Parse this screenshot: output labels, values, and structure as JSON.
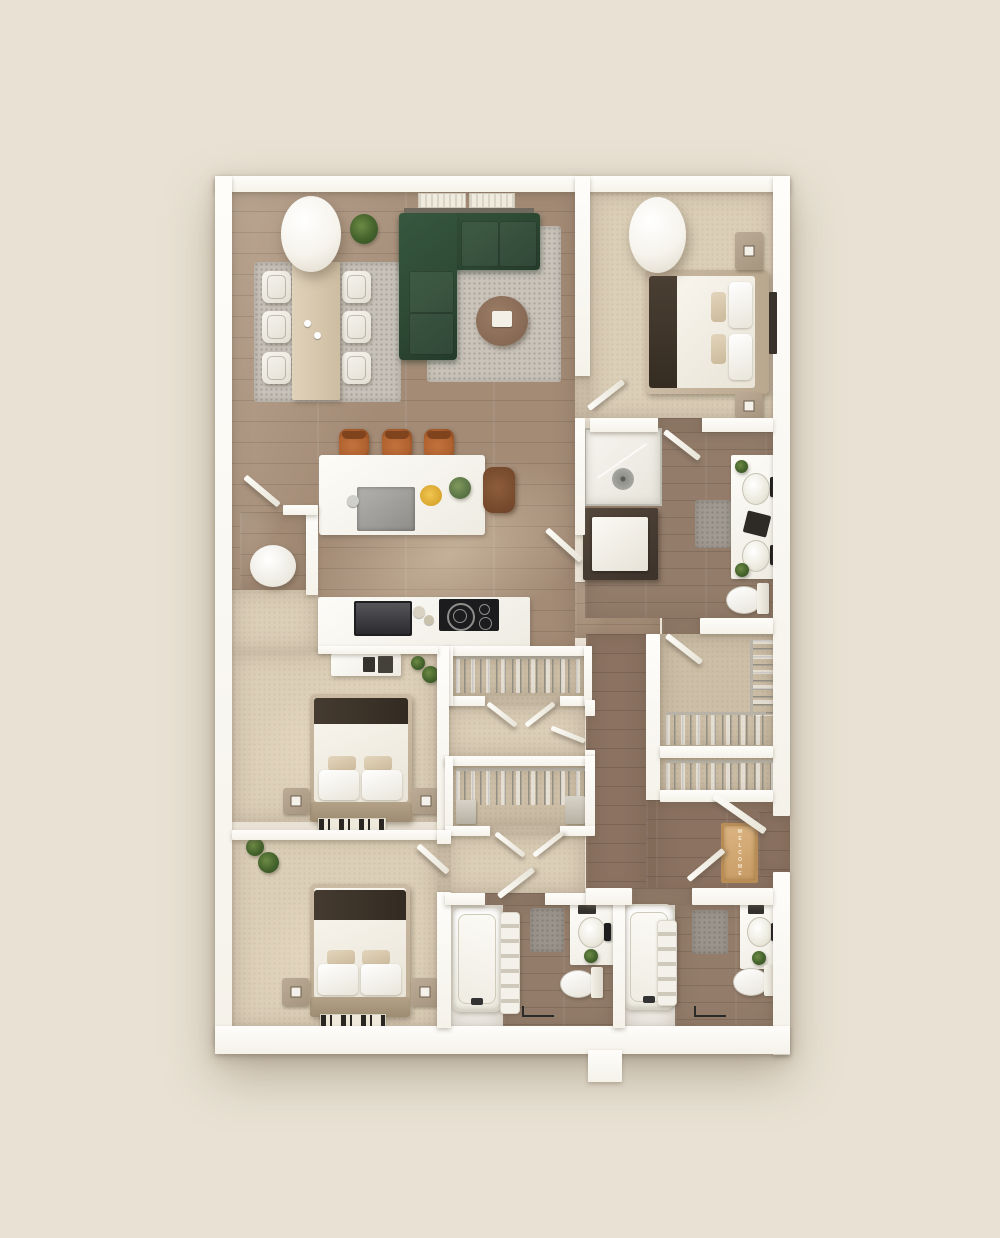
{
  "scene": {
    "type": "3d-top-down-apartment-floor-plan",
    "welcome_mat_text": "WELCOME",
    "bedrooms": 3,
    "bathrooms": 3
  },
  "colors": {
    "bg": "#e9e2d4",
    "wall": "#fbfaf6",
    "wood": "#a38b76",
    "wood-dark": "#8b7261",
    "tile": "#937c6a",
    "carpet": "#dccfb8",
    "carpet-dark": "#cdbfa7",
    "rug": "#c9c3ba",
    "sofa": "#2e4b35",
    "stool": "#b0622f",
    "bed-blanket": "#3b332a",
    "bench": "#a9997f",
    "mat": "#d0a873",
    "plant": "#4f7032",
    "appliance": "#3c3c3e",
    "cooktop": "#1c1c1e"
  },
  "rooms": [
    {
      "id": "living-dining-kitchen",
      "furnishings": [
        "sectional-sofa",
        "area-rug",
        "round-coffee-table",
        "dining-table",
        "dining-chairs-x6",
        "dining-rug",
        "kitchen-island",
        "island-sink",
        "bar-stools-x3",
        "desk-chair",
        "wall-oven",
        "cooktop",
        "floor-plant",
        "pendant-column",
        "windows-x2"
      ]
    },
    {
      "id": "bedroom-1",
      "furnishings": [
        "bed",
        "nightstands-x2",
        "wall-art",
        "pendant-column"
      ]
    },
    {
      "id": "ensuite-bathroom",
      "furnishings": [
        "walk-in-shower",
        "laundry-closet",
        "double-vanity",
        "toilet",
        "bath-mat"
      ]
    },
    {
      "id": "walk-in-closet",
      "furnishings": [
        "hanging-rods-x2"
      ]
    },
    {
      "id": "reach-in-closet",
      "furnishings": [
        "hanging-rod"
      ]
    },
    {
      "id": "entry",
      "furnishings": [
        "front-door",
        "welcome-mat"
      ]
    },
    {
      "id": "hall-closet-a",
      "furnishings": [
        "hanging-rod",
        "double-doors"
      ]
    },
    {
      "id": "hall-closet-b",
      "furnishings": [
        "hanging-rod",
        "shelf-stacks",
        "double-doors"
      ]
    },
    {
      "id": "bedroom-2",
      "furnishings": [
        "bed",
        "nightstands-x2",
        "dresser",
        "runner-rug",
        "potted-plants"
      ]
    },
    {
      "id": "bedroom-3",
      "furnishings": [
        "bed",
        "nightstands-x2",
        "runner-rug",
        "potted-plants"
      ]
    },
    {
      "id": "bathroom-2",
      "furnishings": [
        "bathtub",
        "towel-ladder",
        "vanity",
        "toilet",
        "bath-mat",
        "towel-bar"
      ]
    },
    {
      "id": "bathroom-3",
      "furnishings": [
        "bathtub",
        "towel-ladder",
        "vanity",
        "toilet",
        "bath-mat",
        "towel-bar"
      ]
    }
  ]
}
